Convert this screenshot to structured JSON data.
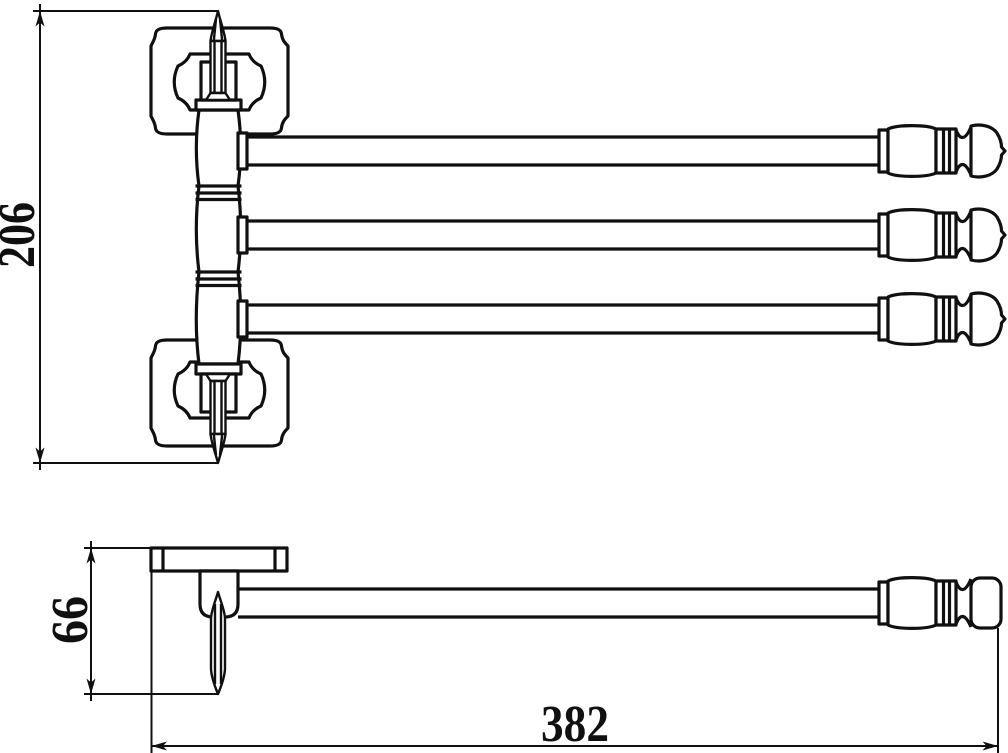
{
  "page": {
    "background_color": "#ffffff",
    "line_color": "#101010",
    "drawing_type": "technical dimensional drawing"
  },
  "dimensions": {
    "overall_height": "206",
    "mount_depth": "66",
    "arm_length": "382"
  }
}
